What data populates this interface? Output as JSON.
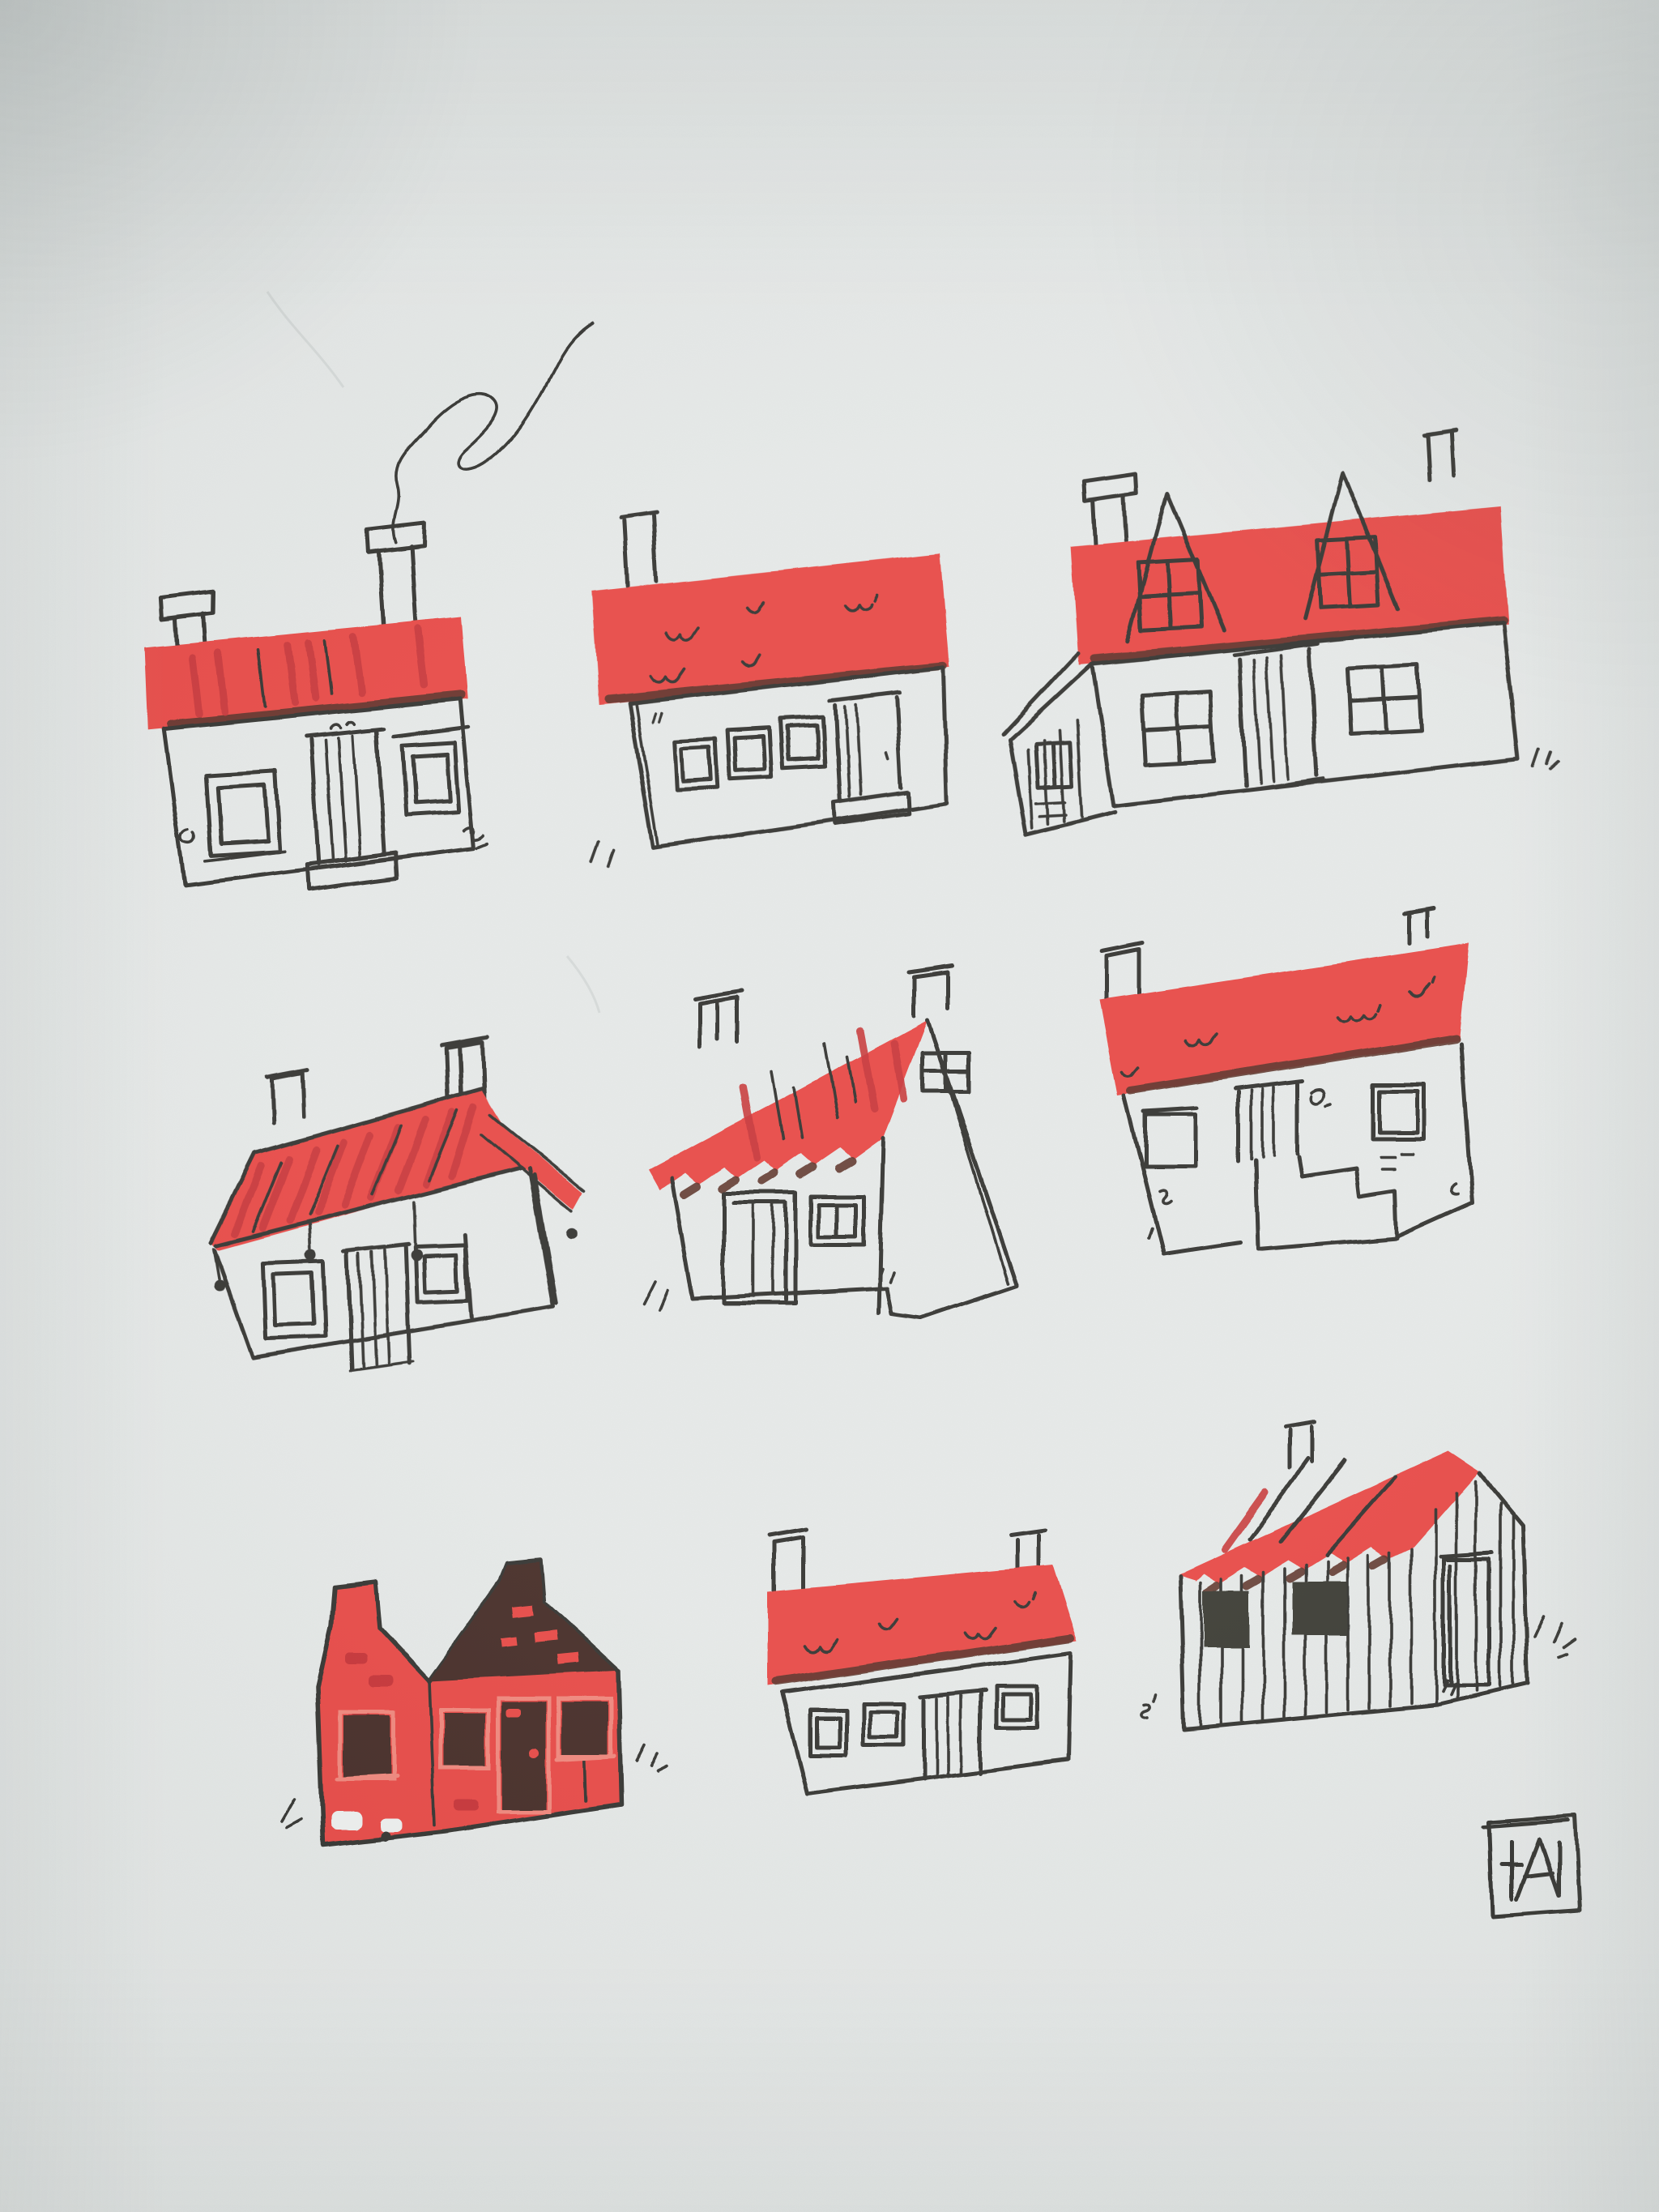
{
  "meta": {
    "alt": "Photograph of a hand-drawn ink illustration on pale grey paper: nine small houses with bright red risograph-style roofs arranged in a three-by-three grid, smoke curling from the first house's chimney, with a boxed monogram signature in the lower right corner."
  },
  "palette": {
    "paper": "#e5e8e7",
    "paper_bright": "#edefee",
    "ink": "#2b2a28",
    "red": "#e6413d",
    "red_deep": "#c32b2f",
    "red_light": "#ef8175",
    "brown": "#3c241c",
    "shadow": "#53291f",
    "window_dark": "#32312b",
    "pencil": "#c9cecc"
  },
  "artwork": {
    "title": "Nine red-roofed houses",
    "medium": "ink sketch with red print layer",
    "grid": {
      "rows": 3,
      "cols": 3
    },
    "houses": [
      {
        "id": 1,
        "position": "top-left",
        "name": "cottage with two capped chimneys and curling smoke",
        "features": [
          "flat red roof band with streaks",
          "two windows",
          "panelled double door with step",
          "smoke line"
        ]
      },
      {
        "id": 2,
        "position": "top-middle",
        "name": "cottage with three small windows and right-hand door",
        "features": [
          "red roof band with tile squiggles",
          "one chimney",
          "door with step",
          "ground ticks"
        ]
      },
      {
        "id": 3,
        "position": "top-right",
        "name": "house with two dormer windows and side lean-to",
        "features": [
          "red roof band",
          "two dormers with four-pane windows",
          "two chimneys",
          "planked lean-to annex",
          "two four-pane windows",
          "panelled door",
          "grass ticks"
        ]
      },
      {
        "id": 4,
        "position": "middle-left",
        "name": "thatched cottage with tall gable chimney and lean-to strip",
        "features": [
          "sloping red roof with diagonal strokes",
          "drip dots under eave",
          "two windows",
          "panelled door",
          "small chimney"
        ]
      },
      {
        "id": 5,
        "position": "middle-middle",
        "name": "gable-end house with zigzag roof edge",
        "features": [
          "pitched red roof with scalloped eave",
          "two chimneys",
          "gable window",
          "double-framed door",
          "two-pane window",
          "grass ticks"
        ]
      },
      {
        "id": 6,
        "position": "middle-right",
        "name": "house with stepped porch descending to the right",
        "features": [
          "red roof band with tile squiggles",
          "two chimneys",
          "two windows",
          "panelled door",
          "stone steps"
        ]
      },
      {
        "id": 7,
        "position": "bottom-left",
        "name": "all-red twin-gabled house with dark gable",
        "features": [
          "red brick body",
          "dark brown right gable",
          "dark windows with light red frames",
          "dark door with red handle",
          "grass ticks"
        ]
      },
      {
        "id": 8,
        "position": "bottom-middle",
        "name": "low cottage with two windows and panelled door",
        "features": [
          "red roof band with tile squiggles",
          "two chimneys",
          "three windows",
          "door",
          "grass squiggle"
        ]
      },
      {
        "id": 9,
        "position": "bottom-right",
        "name": "planked barn with dark window openings",
        "features": [
          "sloping red roof with streaks",
          "vertical plank walls",
          "two solid dark windows",
          "tall door in gable end",
          "grass tufts"
        ]
      }
    ],
    "smoke": {
      "from": "house 1 right chimney",
      "shape": "looping squiggle rising to the right"
    },
    "signature": {
      "monogram": "A",
      "style": "boxed initials, lower right"
    }
  }
}
